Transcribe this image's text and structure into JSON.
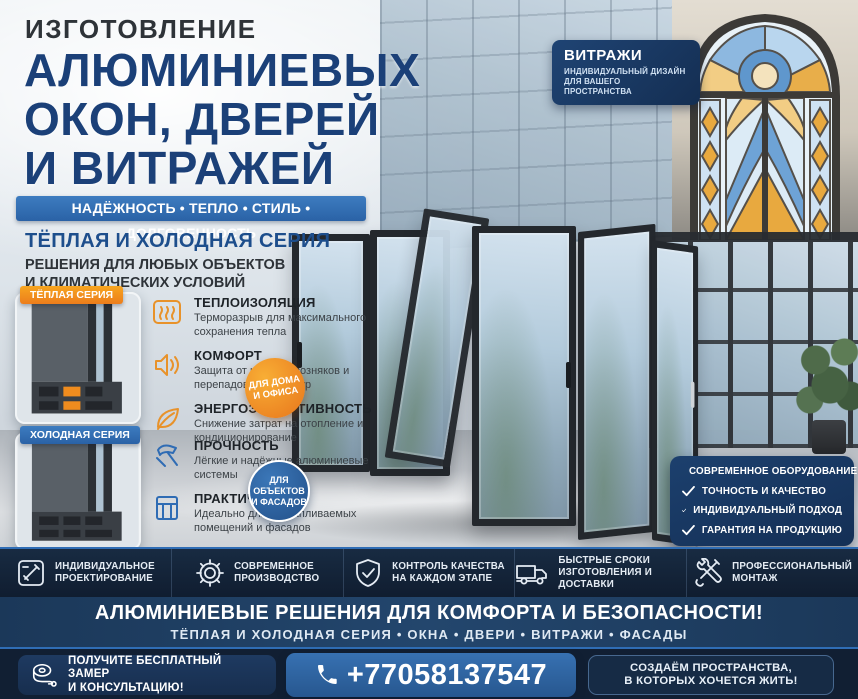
{
  "colors": {
    "accent_orange": "#f08c1e",
    "accent_blue": "#2f6cb4",
    "navy_panel": "#142f55",
    "title_navy": "#1b4078"
  },
  "header": {
    "kicker": "ИЗГОТОВЛЕНИЕ",
    "title_lines": [
      "АЛЮМИНИЕВЫХ",
      "ОКОН, ДВЕРЕЙ",
      "И ВИТРАЖЕЙ"
    ],
    "ribbon": "НАДЁЖНОСТЬ • ТЕПЛО • СТИЛЬ • ДОЛГОВЕЧНОСТЬ",
    "vitrazhi_badge": {
      "title": "ВИТРАЖИ",
      "sub_line1": "ИНДИВИДУАЛЬНЫЙ ДИЗАЙН",
      "sub_line2": "ДЛЯ ВАШЕГО ПРОСТРАНСТВА"
    }
  },
  "series_intro": {
    "title": "ТЁПЛАЯ И ХОЛОДНАЯ СЕРИЯ",
    "sub_line1": "РЕШЕНИЯ ДЛЯ ЛЮБЫХ ОБЪЕКТОВ",
    "sub_line2": "И КЛИМАТИЧЕСКИХ УСЛОВИЙ"
  },
  "warm_series": {
    "tag": "ТЁПЛАЯ СЕРИЯ",
    "features": [
      {
        "icon": "thermal-insulation-icon",
        "title": "ТЕПЛОИЗОЛЯЦИЯ",
        "desc": "Терморазрыв для максимального сохранения тепла"
      },
      {
        "icon": "comfort-icon",
        "title": "КОМФОРТ",
        "desc": "Защита от шума, сквозняков и перепадов температур"
      },
      {
        "icon": "energy-efficiency-icon",
        "title": "ЭНЕРГОЭФФЕКТИВНОСТЬ",
        "desc": "Снижение затрат на отопление и кондиционирование"
      }
    ],
    "badge_line1": "ДЛЯ ДОМА",
    "badge_line2": "И ОФИСА"
  },
  "cold_series": {
    "tag": "ХОЛОДНАЯ СЕРИЯ",
    "features": [
      {
        "icon": "durability-icon",
        "title": "ПРОЧНОСТЬ",
        "desc": "Лёгкие и надёжные алюминиевые системы"
      },
      {
        "icon": "practicality-icon",
        "title": "ПРАКТИЧНОСТЬ",
        "desc": "Идеально для неотапливаемых помещений и фасадов"
      },
      {
        "icon": "affordability-icon",
        "title": "ДОСТУПНОСТЬ",
        "desc": "Оптимальное решение по выгодной цене"
      }
    ],
    "badge_line1": "ДЛЯ",
    "badge_line2": "ОБЪЕКТОВ",
    "badge_line3": "И ФАСАДОВ"
  },
  "advantages": {
    "items": [
      "СОВРЕМЕННОЕ ОБОРУДОВАНИЕ",
      "ТОЧНОСТЬ И КАЧЕСТВО",
      "ИНДИВИДУАЛЬНЫЙ ПОДХОД",
      "ГАРАНТИЯ НА ПРОДУКЦИЮ"
    ]
  },
  "services": {
    "items": [
      {
        "icon": "design-ruler-icon",
        "line1": "ИНДИВИДУАЛЬНОЕ",
        "line2": "ПРОЕКТИРОВАНИЕ"
      },
      {
        "icon": "gear-icon",
        "line1": "СОВРЕМЕННОЕ",
        "line2": "ПРОИЗВОДСТВО"
      },
      {
        "icon": "shield-check-icon",
        "line1": "КОНТРОЛЬ КАЧЕСТВА",
        "line2": "НА КАЖДОМ ЭТАПЕ"
      },
      {
        "icon": "truck-icon",
        "line1": "БЫСТРЫЕ СРОКИ",
        "line2": "ИЗГОТОВЛЕНИЯ И ДОСТАВКИ"
      },
      {
        "icon": "tools-icon",
        "line1": "ПРОФЕССИОНАЛЬНЫЙ",
        "line2": "МОНТАЖ"
      }
    ]
  },
  "slogan": {
    "line1": "АЛЮМИНИЕВЫЕ РЕШЕНИЯ ДЛЯ КОМФОРТА И БЕЗОПАСНОСТИ!",
    "line2": "ТЁПЛАЯ И ХОЛОДНАЯ СЕРИЯ • ОКНА • ДВЕРИ • ВИТРАЖИ • ФАСАДЫ"
  },
  "footer": {
    "cta_line1": "ПОЛУЧИТЕ БЕСПЛАТНЫЙ ЗАМЕР",
    "cta_line2": "И КОНСУЛЬТАЦИЮ!",
    "phone": "+77058137547",
    "tagline_line1": "СОЗДАЁМ ПРОСТРАНСТВА,",
    "tagline_line2": "В КОТОРЫХ ХОЧЕТСЯ ЖИТЬ!"
  }
}
